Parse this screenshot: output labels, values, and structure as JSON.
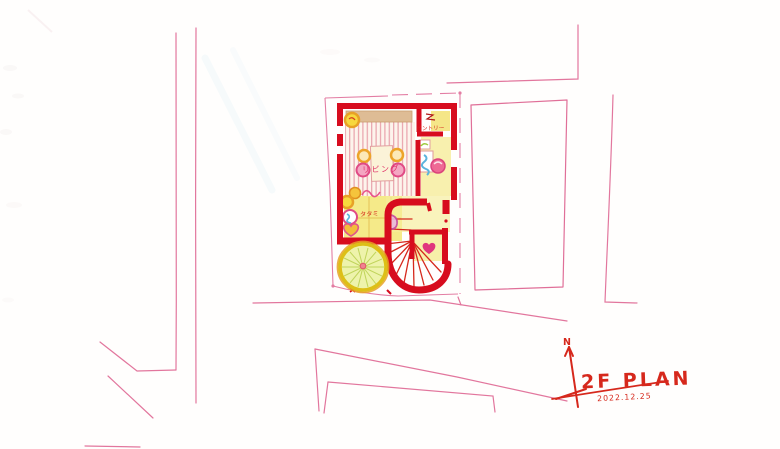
{
  "title_block": {
    "north_label": "N",
    "title": "2F PLAN",
    "date": "2022.12.25"
  },
  "plan_labels": {
    "living": "リビング",
    "pantry": "パントリー",
    "tatami": "タタミ"
  },
  "colors": {
    "wall_red": "#d70c1e",
    "sketch_pink": "#dd5f8d",
    "annotation_red": "#d6281c",
    "floor_yellow": "#f4e87c",
    "wood_stripe_pink": "#e9a2ac",
    "counter_tan": "#d9b184",
    "accent_orange": "#eda429",
    "accent_magenta": "#e04a85",
    "accent_blue": "#5bb4dc",
    "tree_fill": "#eef3ab",
    "tree_ring_yellow": "#ddbf17"
  }
}
